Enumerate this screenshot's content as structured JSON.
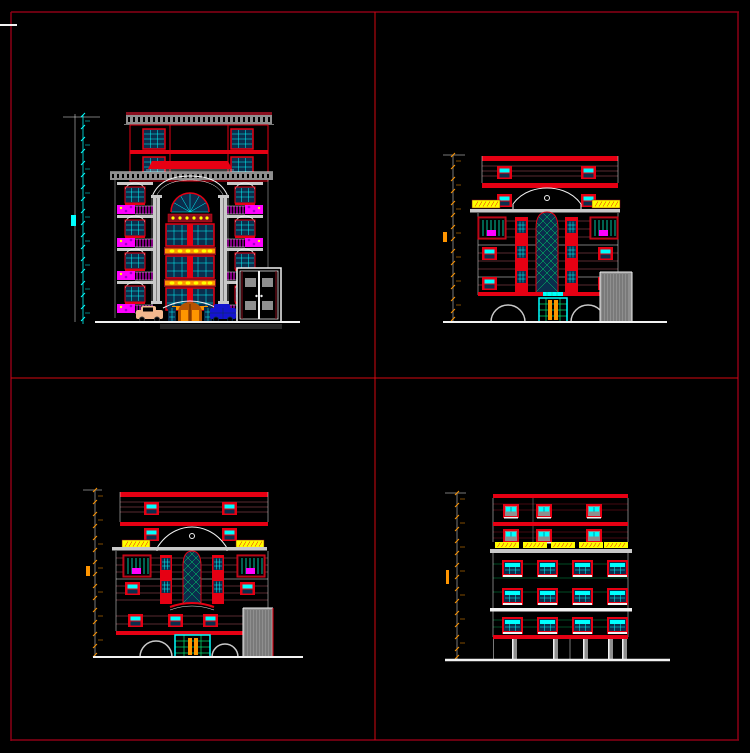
{
  "canvas": {
    "width": 750,
    "height": 753,
    "background": "#000000",
    "sheet_border_color": "#8c0016",
    "viewport_divider_color": "#d40810"
  },
  "palette": {
    "bg": "#000000",
    "border": "#8c0016",
    "divider": "#d40810",
    "white": "#f2f2f2",
    "grayLight": "#c9c9c9",
    "gray": "#8f8f8f",
    "grayDark": "#3d3d3d",
    "red": "#e60013",
    "redDark": "#8a0f1e",
    "pink": "#b05560",
    "cyan": "#00ffff",
    "navy": "#0a2e4d",
    "magenta": "#ff00ff",
    "purple": "#a100c8",
    "yellow": "#ffff00",
    "orange": "#ff9500",
    "orangeDeep": "#b65300",
    "green": "#00d96a",
    "teal": "#00c4a0",
    "tan": "#f4b98e",
    "carBlue": "#1414cf"
  },
  "viewports": [
    {
      "position": "top-left",
      "drawing": "building-front-elevation",
      "dimension_string_color": "#00ffff"
    },
    {
      "position": "top-right",
      "drawing": "building-side-elevation-a",
      "dimension_string_color": "#ff9500"
    },
    {
      "position": "bottom-left",
      "drawing": "building-side-elevation-b",
      "dimension_string_color": "#ff9500"
    },
    {
      "position": "bottom-right",
      "drawing": "building-rear-elevation",
      "dimension_string_color": "#ff9500"
    }
  ],
  "notes": {
    "dimension_text_legible": false
  }
}
